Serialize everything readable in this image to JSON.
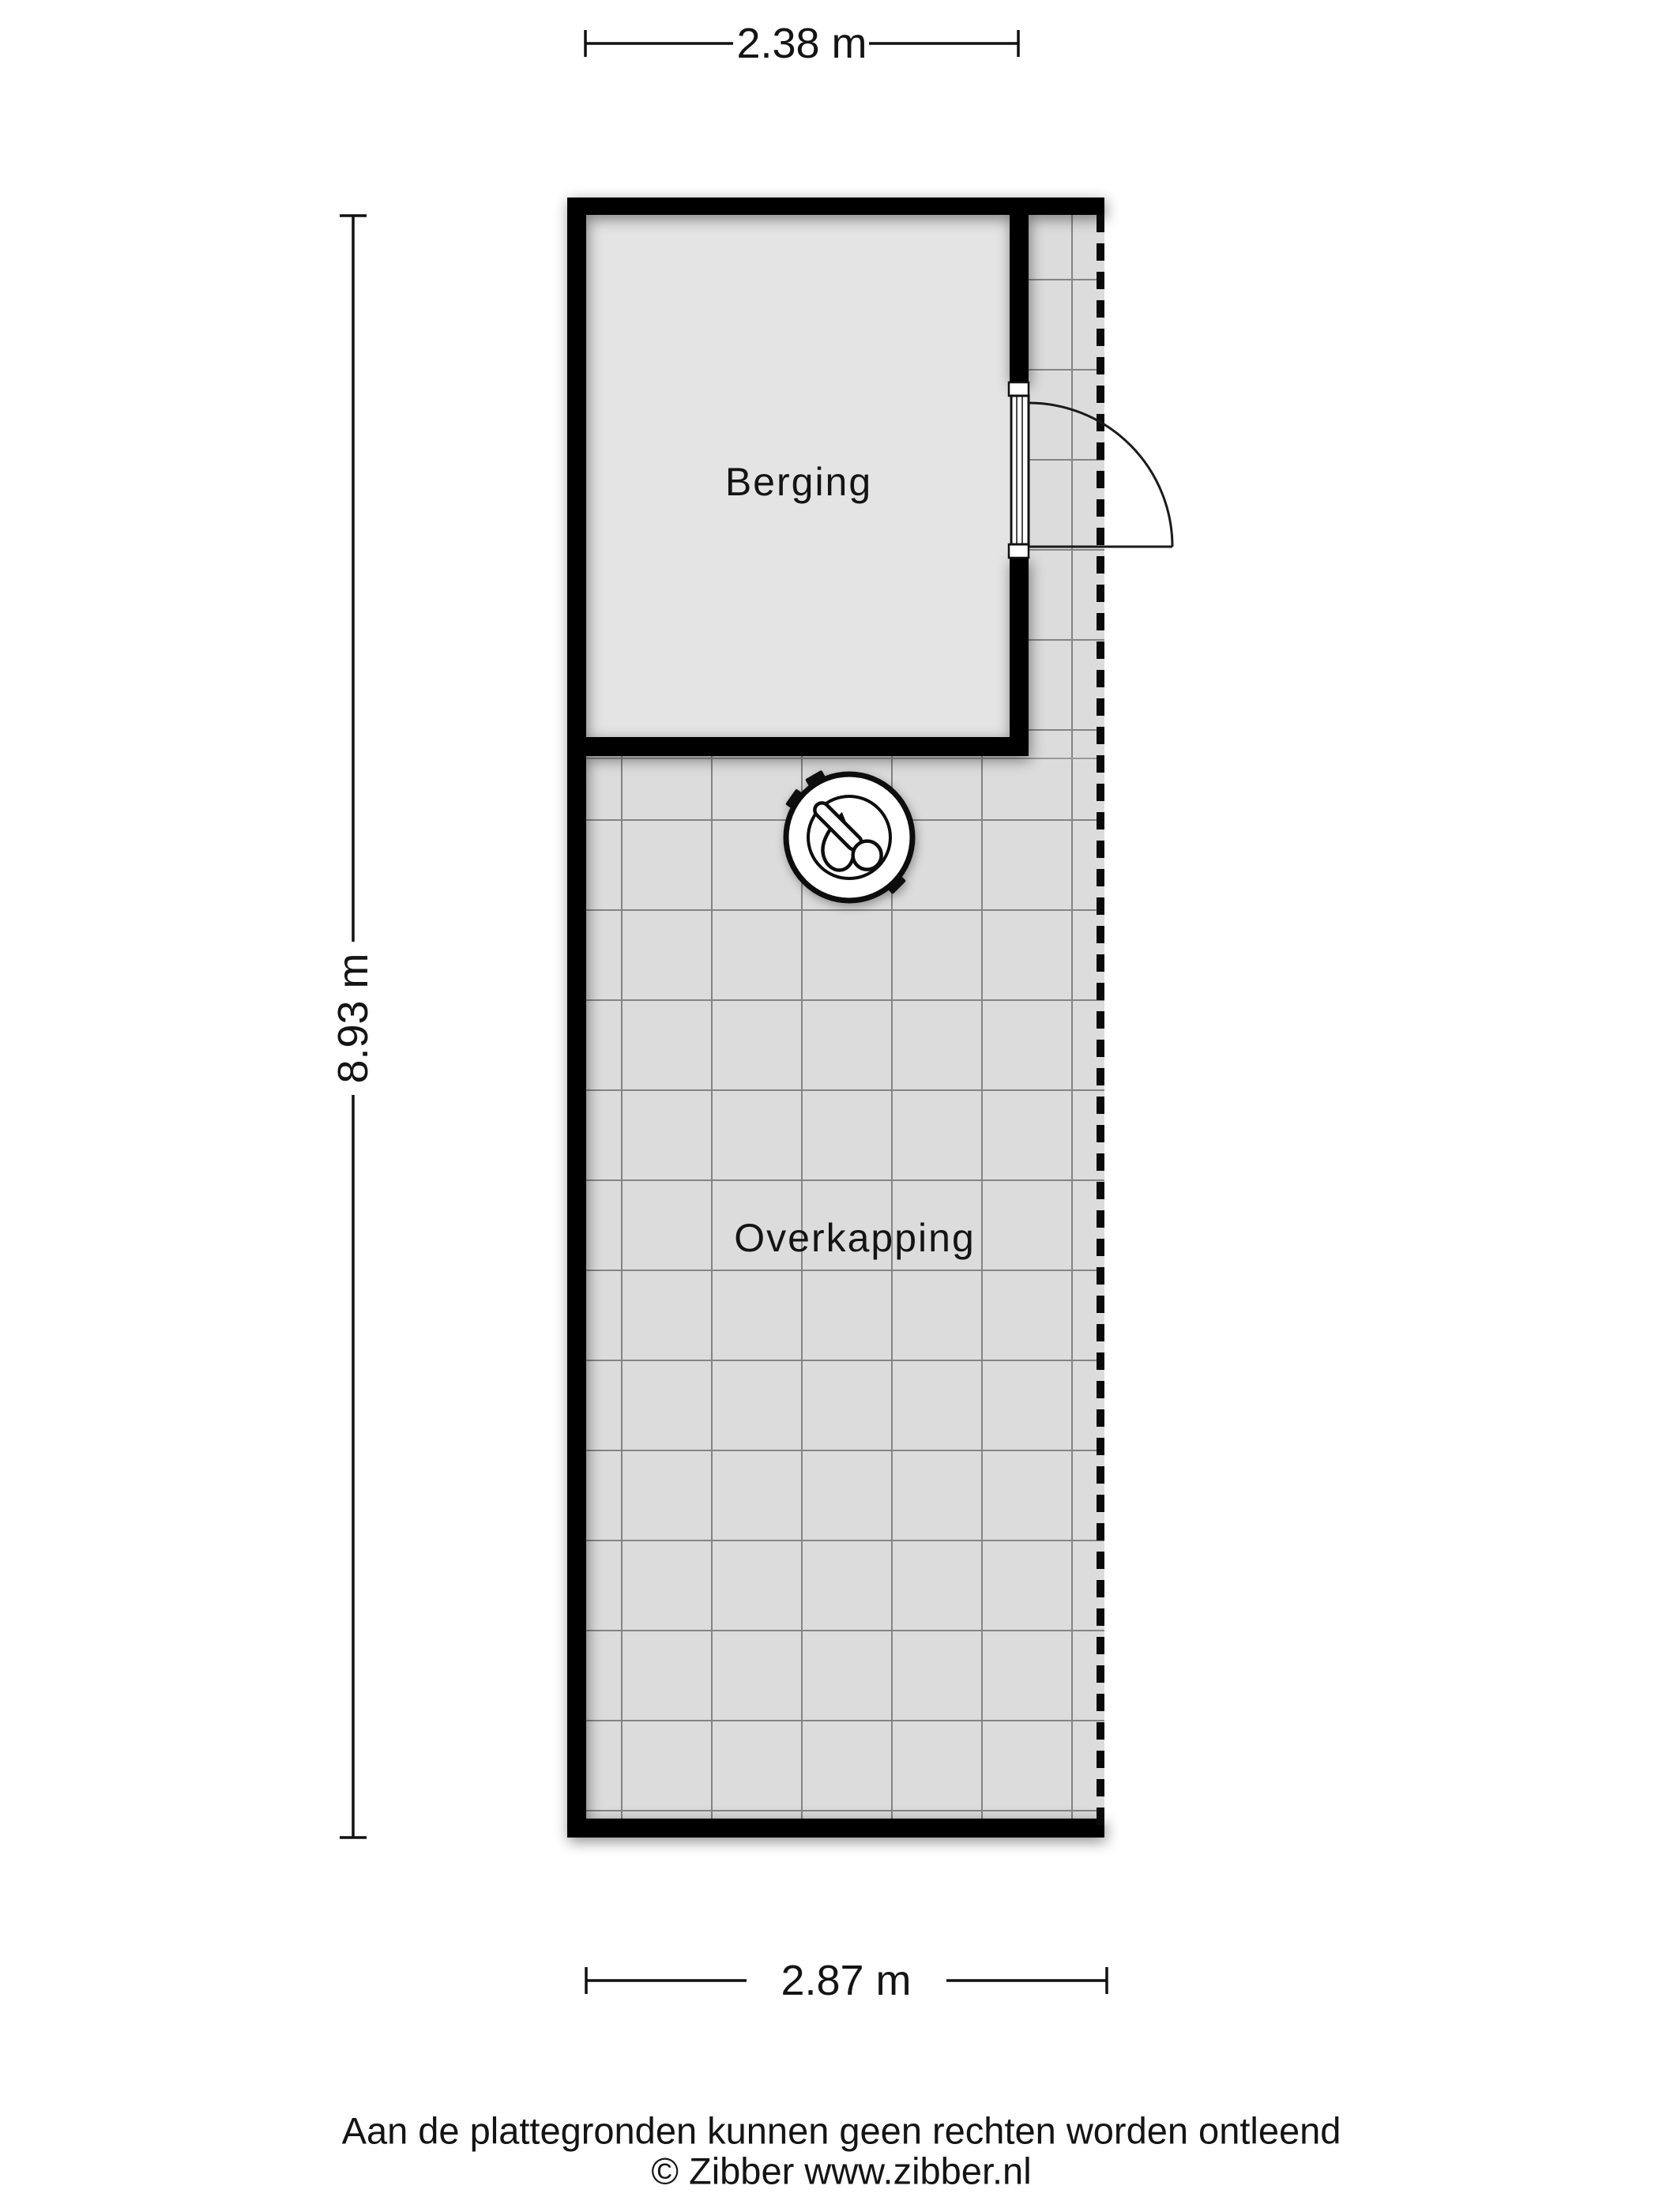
{
  "floorplan": {
    "rooms": [
      {
        "name": "Berging"
      },
      {
        "name": "Overkapping"
      }
    ],
    "dimensions": {
      "top": {
        "label": "2.38 m"
      },
      "left": {
        "label": "8.93 m"
      },
      "bottom": {
        "label": "2.87 m"
      }
    },
    "icons": {
      "boiler": "boiler-thermometer-icon"
    },
    "colors": {
      "wall": "#000000",
      "berging_floor": "#e4e4e4",
      "tile_floor": "#dcdcdc",
      "grid_line": "#848484",
      "outline": "#111111",
      "page_bg": "#ffffff"
    }
  },
  "footer": {
    "disclaimer": "Aan de plattegronden kunnen geen rechten worden ontleend",
    "copyright": "© Zibber www.zibber.nl"
  }
}
